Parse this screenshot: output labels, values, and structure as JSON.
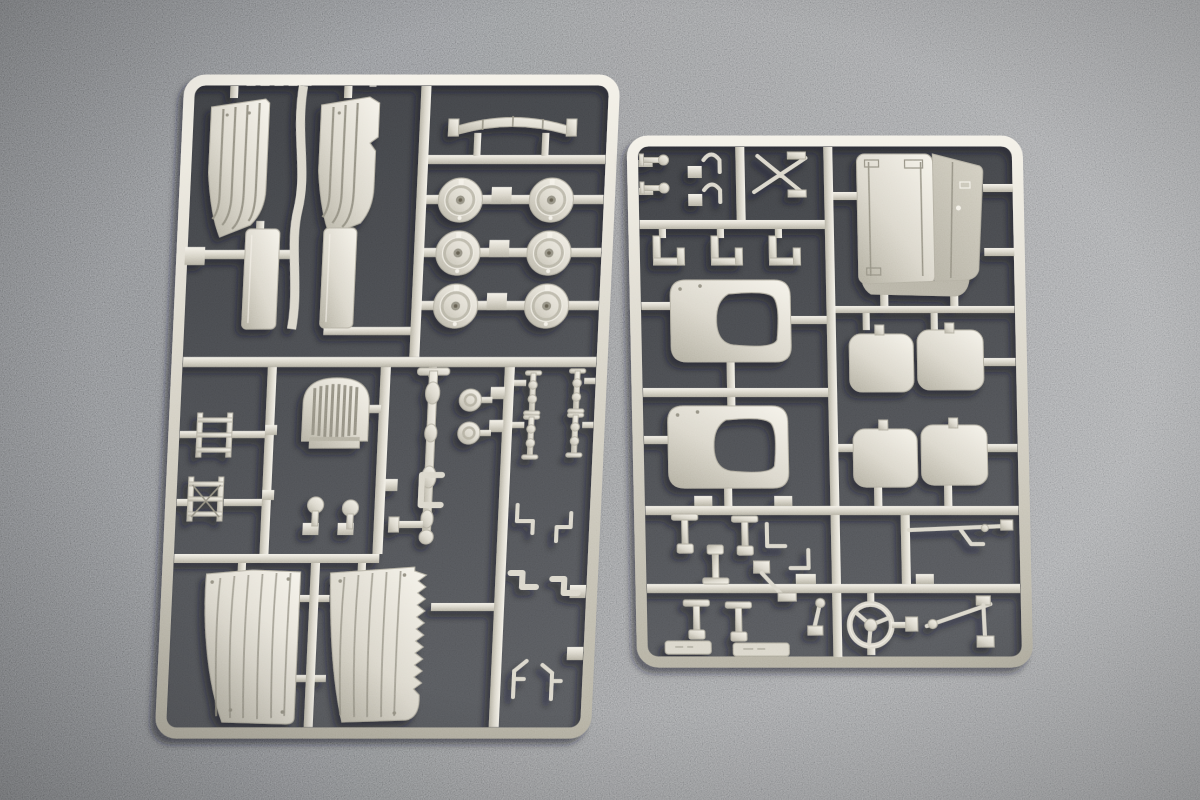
{
  "meta": {
    "description": "Photograph of two cream-colored injection-molded plastic model kit sprues (part frames) for a scale truck kit, lying on a dark gray speckled surface",
    "scene": "model-kit sprue product photo",
    "visible_text": ""
  },
  "colors": {
    "bg-left": "#707275",
    "bg-mid": "#7f8184",
    "bg-right": "#949699",
    "interior-dark": "#3d3f43",
    "interior-mid": "#54565a",
    "plastic-hi": "#f3f0e7",
    "plastic-base": "#d9d5c9",
    "plastic-sh": "#b2ae9f",
    "groove": "#8f8b7d",
    "edge": "#b0ac9e",
    "darkface-a": "#cfcbbd",
    "darkface-b": "#b4b0a2"
  },
  "sprues": {
    "left": {
      "label": "left sprue with fenders, wheel hubs, grille and mud flaps",
      "parts": [
        "fender panel x2",
        "sill bar x2",
        "leaf spring",
        "wheel hub x6",
        "access ladder x2",
        "radiator grille",
        "ball-head pin x2",
        "drive shaft",
        "spotlight x2",
        "tie rod x4",
        "corner bracket x3",
        "mud flap x2",
        "hook fitting x4"
      ]
    },
    "right": {
      "label": "right sprue with cab tub, seat frames, cushions and steering wheel",
      "parts": [
        "cab floor tub",
        "seat backrest frame x2",
        "seat cushion pair x2",
        "steering wheel",
        "head pin x2",
        "clamp x2",
        "wiper cross piece",
        "channel bracket x3",
        "t-bracket x4",
        "l-bracket x2",
        "name plate x2",
        "lever assembly",
        "linkage rod",
        "pedal bracket",
        "gear lever"
      ]
    }
  }
}
